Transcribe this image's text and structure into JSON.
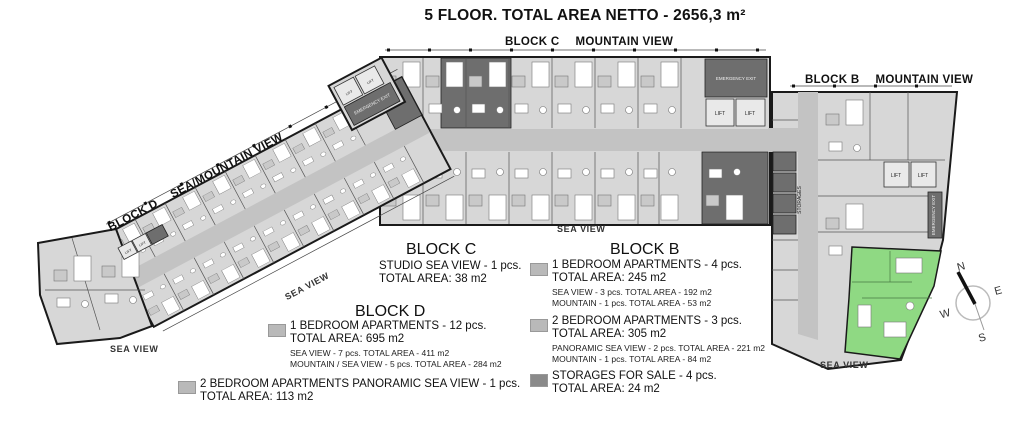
{
  "title": "5 FLOOR. TOTAL AREA NETTO - 2656,3 m²",
  "headers": {
    "block_c": {
      "name": "BLOCK C",
      "view": "MOUNTAIN VIEW"
    },
    "block_b": {
      "name": "BLOCK B",
      "view": "MOUNTAIN VIEW"
    },
    "block_d": {
      "name": "BLOCK D",
      "view": "SEA/MOUNTAIN VIEW"
    }
  },
  "view_labels": {
    "sea_view": "SEA VIEW"
  },
  "rooms": {
    "lift": "LIFT",
    "storages": "STORAGES",
    "emergency_exit": "EMERGENCY EXIT"
  },
  "compass": {
    "n": "N",
    "e": "E",
    "s": "S",
    "w": "W"
  },
  "legend": {
    "block_c": {
      "title": "BLOCK C",
      "entries": [
        {
          "swatch": null,
          "label": "STUDIO SEA VIEW - 1 pcs.",
          "total": "TOTAL AREA: 38 m2",
          "details": []
        }
      ]
    },
    "block_d": {
      "title": "BLOCK D",
      "entries": [
        {
          "swatch": "#b9b9b9",
          "label": "1 BEDROOM APARTMENTS - 12 pcs.",
          "total": "TOTAL AREA: 695 m2",
          "details": [
            "SEA VIEW - 7 pcs. TOTAL AREA - 411 m2",
            "MOUNTAIN / SEA VIEW - 5 pcs. TOTAL AREA - 284 m2"
          ]
        },
        {
          "swatch": "#b9b9b9",
          "label": "2 BEDROOM APARTMENTS PANORAMIC SEA VIEW - 1 pcs.",
          "total": "TOTAL AREA: 113 m2",
          "details": []
        }
      ]
    },
    "block_b": {
      "title": "BLOCK B",
      "entries": [
        {
          "swatch": "#b9b9b9",
          "label": "1 BEDROOM APARTMENTS - 4 pcs.",
          "total": "TOTAL AREA: 245 m2",
          "details": [
            "SEA VIEW - 3 pcs. TOTAL AREA - 192 m2",
            "MOUNTAIN - 1 pcs. TOTAL AREA - 53 m2"
          ]
        },
        {
          "swatch": "#b9b9b9",
          "label": "2 BEDROOM APARTMENTS - 3 pcs.",
          "total": "TOTAL AREA: 305 m2",
          "details": [
            "PANORAMIC SEA VIEW - 2 pcs. TOTAL AREA - 221 m2",
            "MOUNTAIN - 1 pcs. TOTAL AREA - 84 m2"
          ]
        },
        {
          "swatch": "#8a8a8a",
          "label": "STORAGES FOR SALE - 4 pcs.",
          "total": "TOTAL AREA: 24 m2",
          "details": []
        }
      ]
    }
  },
  "colors": {
    "highlight_green": "#8fd983",
    "unit_gray": "#d7d7d7",
    "corridor_gray": "#c3c3c3",
    "dark_gray": "#6e6e6e",
    "swatch_gray": "#b9b9b9",
    "swatch_dark": "#8a8a8a",
    "wall_black": "#1a1a1a"
  }
}
